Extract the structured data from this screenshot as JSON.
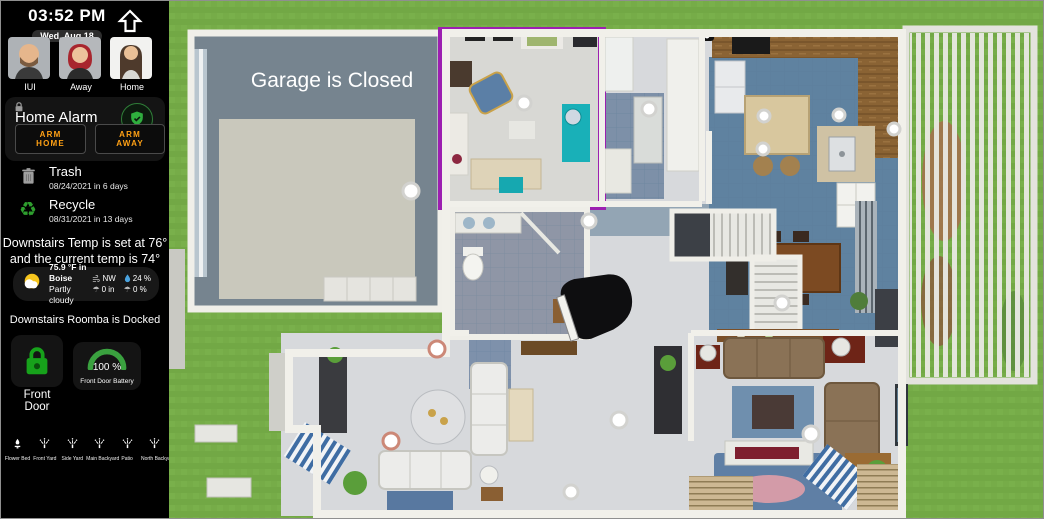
{
  "sidebar": {
    "clock": {
      "time": "03:52 PM",
      "date": "Wed, Aug 18"
    },
    "people": [
      {
        "name": "IUI"
      },
      {
        "name": "Away"
      },
      {
        "name": "Home"
      }
    ],
    "alarm": {
      "title": "Home Alarm",
      "arm_home_label": "ARM HOME",
      "arm_away_label": "ARM AWAY"
    },
    "trash": {
      "label": "Trash",
      "detail": "08/24/2021 in 6 days"
    },
    "recycle": {
      "label": "Recycle",
      "detail": "08/31/2021 in 13 days"
    },
    "temp_message_line1": "Downstairs Temp is set at 76°",
    "temp_message_line2": "and the current temp is 74°",
    "weather": {
      "temp": "75.9 °F in Boise",
      "condition": "Partly cloudy",
      "wind": "NW",
      "humidity": "24 %",
      "precipitation": "0 in",
      "precip_probability": "0 %"
    },
    "roomba_message": "Downstairs Roomba is Docked",
    "front_door": {
      "label": "Front Door",
      "battery_value": "100 %",
      "battery_label": "Front Door Battery"
    },
    "sprinklers": [
      {
        "label": "Flower Bed"
      },
      {
        "label": "Front Yard"
      },
      {
        "label": "Side Yard"
      },
      {
        "label": "Main Backyard"
      },
      {
        "label": "Patio"
      },
      {
        "label": "North Backyard"
      }
    ]
  },
  "floorplan": {
    "garage_status": "Garage is Closed"
  },
  "colors": {
    "sidebar_bg": "#000000",
    "accent_amber": "#ffa115",
    "status_green": "#2fae3e",
    "lock_green": "#17a21b",
    "grass": "#76ad46",
    "floor_gray": "#d7d9dc",
    "floor_blue": "#5f82a0",
    "room_highlight_purple": "#9c1fb0",
    "wood": "#8a6334"
  }
}
